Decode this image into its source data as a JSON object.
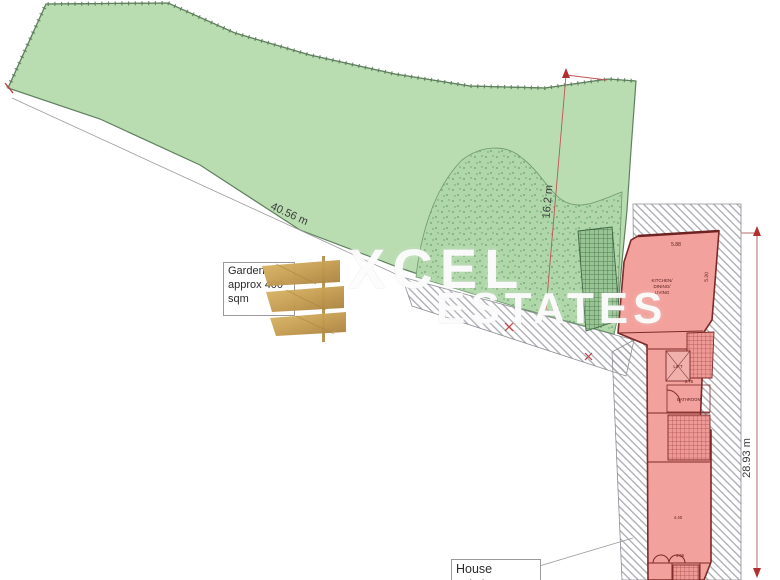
{
  "watermark": {
    "line1": "XCEL",
    "line2": "ESTATES"
  },
  "garden_note": {
    "line1": "Garden",
    "line2": "approx 400",
    "line3": "sqm"
  },
  "house_note": {
    "line1": "House",
    "line2": "existing"
  },
  "dimensions": {
    "garden_width": "40.56 m",
    "garden_depth": "16.2 m",
    "site_depth": "28.93 m",
    "house_top_width": "5.88",
    "house_right_depth": "5.20",
    "bathroom_width": "2.75",
    "lower_room_width": "4.40",
    "bottom_room_width": "4.06"
  },
  "rooms": {
    "kitchen_line1": "KITCHEN/",
    "kitchen_line2": "DINING/",
    "kitchen_line3": "LIVING",
    "lift": "LIFT",
    "bathroom": "BATHROOM"
  },
  "colors": {
    "garden_green": "#b9dcb1",
    "stipple_green": "#b0d7a9",
    "house_red": "#f3a19c",
    "dimension_red": "#c05555",
    "gold": "#c9a257",
    "watermark_white": "#ffffff"
  }
}
